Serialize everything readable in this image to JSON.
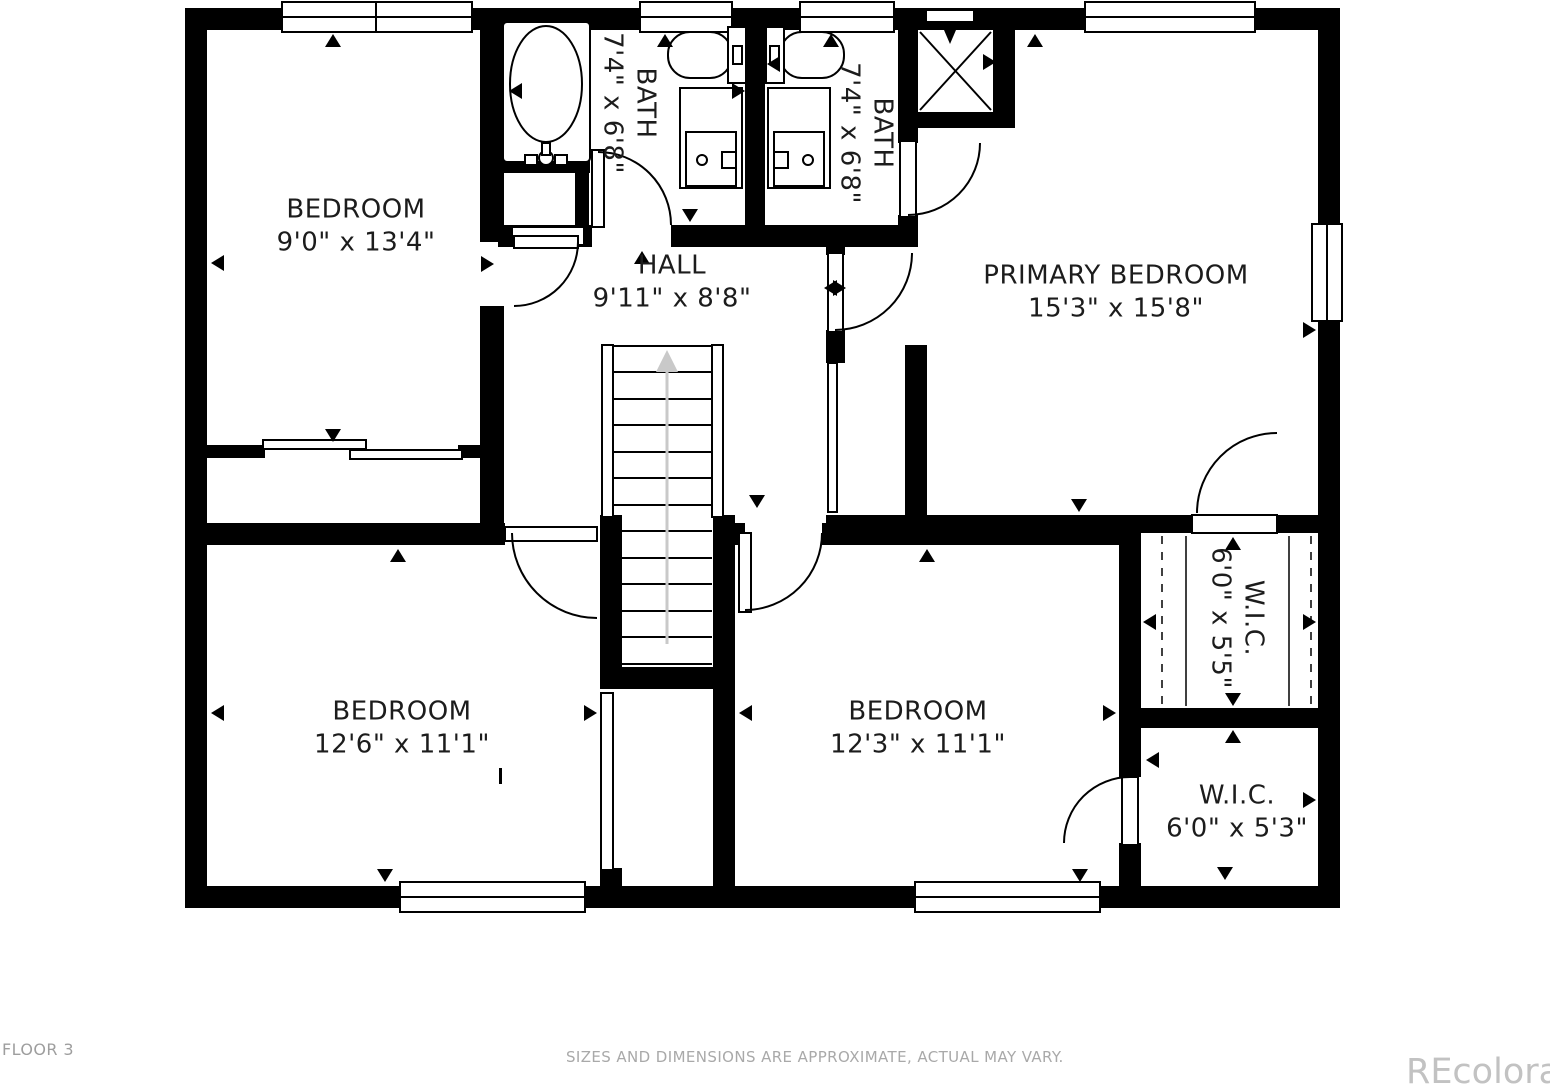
{
  "title": "Floor plan - Floor 3",
  "colors": {
    "wall": "#000000",
    "line": "#000000",
    "stair_arrow": "#c9c9c9",
    "label_text": "#1c1c1c",
    "footer_text": "#a9a9a9",
    "watermark_text": "#c2c2c2",
    "background": "#ffffff"
  },
  "rooms": {
    "bedroom_tl": {
      "name": "BEDROOM",
      "dims": "9'0\" x 13'4\""
    },
    "bath_left": {
      "name": "BATH",
      "dims": "7'4\" x 6'8\""
    },
    "bath_right": {
      "name": "BATH",
      "dims": "7'4\" x 6'8\""
    },
    "hall": {
      "name": "HALL",
      "dims": "9'11\" x 8'8\""
    },
    "primary": {
      "name": "PRIMARY BEDROOM",
      "dims": "15'3\" x 15'8\""
    },
    "bedroom_bl": {
      "name": "BEDROOM",
      "dims": "12'6\" x 11'1\""
    },
    "bedroom_br": {
      "name": "BEDROOM",
      "dims": "12'3\" x 11'1\""
    },
    "wic_upper": {
      "name": "W.I.C.",
      "dims": "6'0\" x 5'5\""
    },
    "wic_lower": {
      "name": "W.I.C.",
      "dims": "6'0\" x 5'3\""
    }
  },
  "fixtures": [
    "bathtub",
    "toilet",
    "toilet",
    "vanity-sink",
    "vanity-sink",
    "shower",
    "stairs-up"
  ],
  "footer": {
    "floor_label": "FLOOR 3",
    "disclaimer": "SIZES AND DIMENSIONS ARE APPROXIMATE, ACTUAL MAY VARY.",
    "watermark": "REcolorado"
  }
}
